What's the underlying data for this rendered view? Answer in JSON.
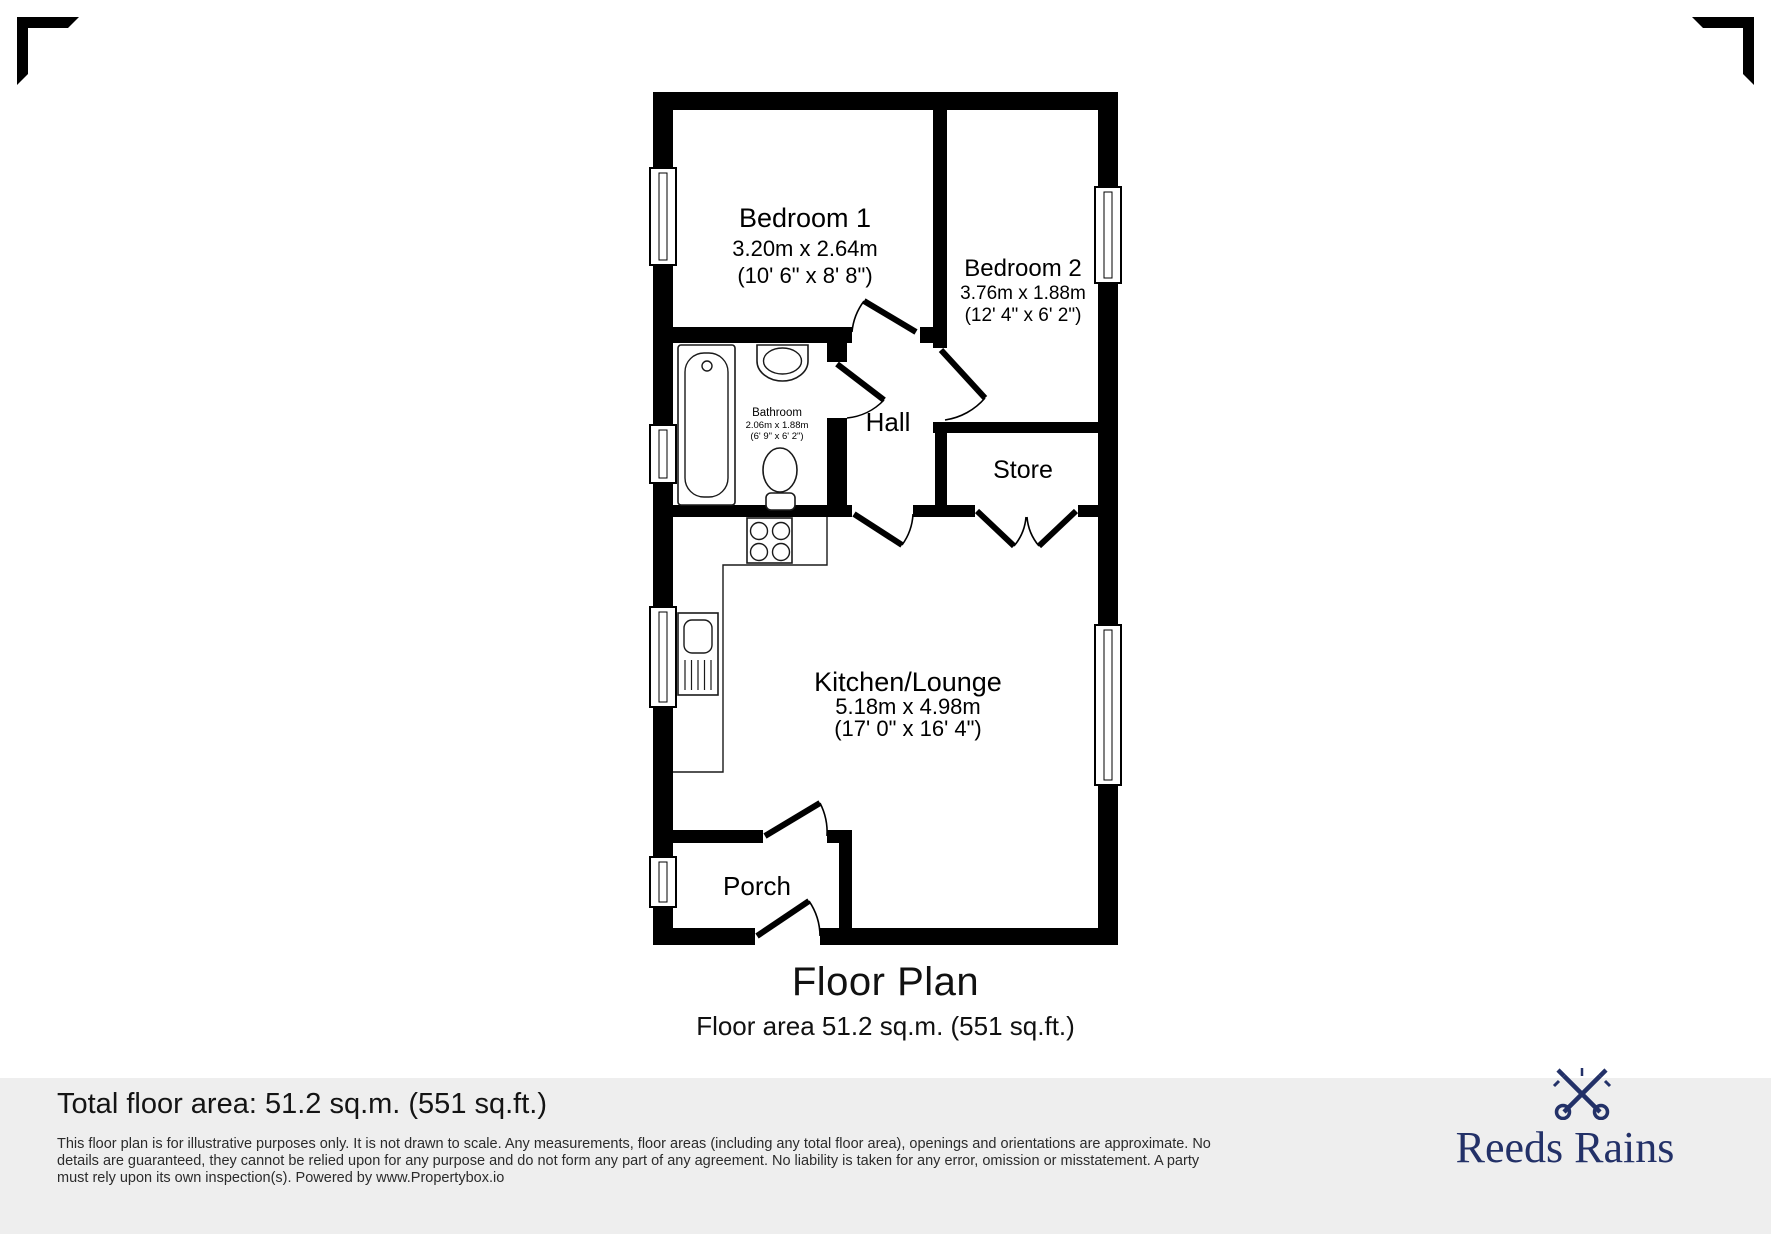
{
  "plan": {
    "title": "Floor Plan",
    "subtitle": "Floor area 51.2 sq.m. (551 sq.ft.)",
    "rooms": {
      "bedroom1": {
        "name": "Bedroom 1",
        "metric": "3.20m x 2.64m",
        "imperial": "(10' 6\" x 8' 8\")"
      },
      "bedroom2": {
        "name": "Bedroom 2",
        "metric": "3.76m x 1.88m",
        "imperial": "(12' 4\" x 6' 2\")"
      },
      "bathroom": {
        "name": "Bathroom",
        "metric": "2.06m x 1.88m",
        "imperial": "(6' 9\" x 6' 2\")"
      },
      "hall": {
        "name": "Hall"
      },
      "store": {
        "name": "Store"
      },
      "kitchen": {
        "name": "Kitchen/Lounge",
        "metric": "5.18m x 4.98m",
        "imperial": "(17' 0\" x 16' 4\")"
      },
      "porch": {
        "name": "Porch"
      }
    }
  },
  "footer": {
    "total_area": "Total floor area: 51.2 sq.m. (551 sq.ft.)",
    "disclaimer_line1": "This floor plan is for illustrative purposes only. It is not drawn to scale. Any measurements, floor areas (including any total floor area), openings and orientations are approximate. No",
    "disclaimer_line2": "details are guaranteed, they cannot be relied upon for any purpose and do not form any part of any agreement. No liability is taken for any error, omission or misstatement. A party",
    "disclaimer_line3": "must rely upon its own inspection(s). Powered by www.Propertybox.io"
  },
  "brand": {
    "name": "Reeds Rains",
    "color": "#233168"
  },
  "icons": {
    "brand_crest": "crossed-keys",
    "fixtures": [
      "bathtub",
      "basin",
      "toilet",
      "hob",
      "sink-drainer",
      "window",
      "door-swing"
    ]
  },
  "colors": {
    "walls": "#000000",
    "footer_band": "#eeeeee",
    "brand_navy": "#233168"
  }
}
